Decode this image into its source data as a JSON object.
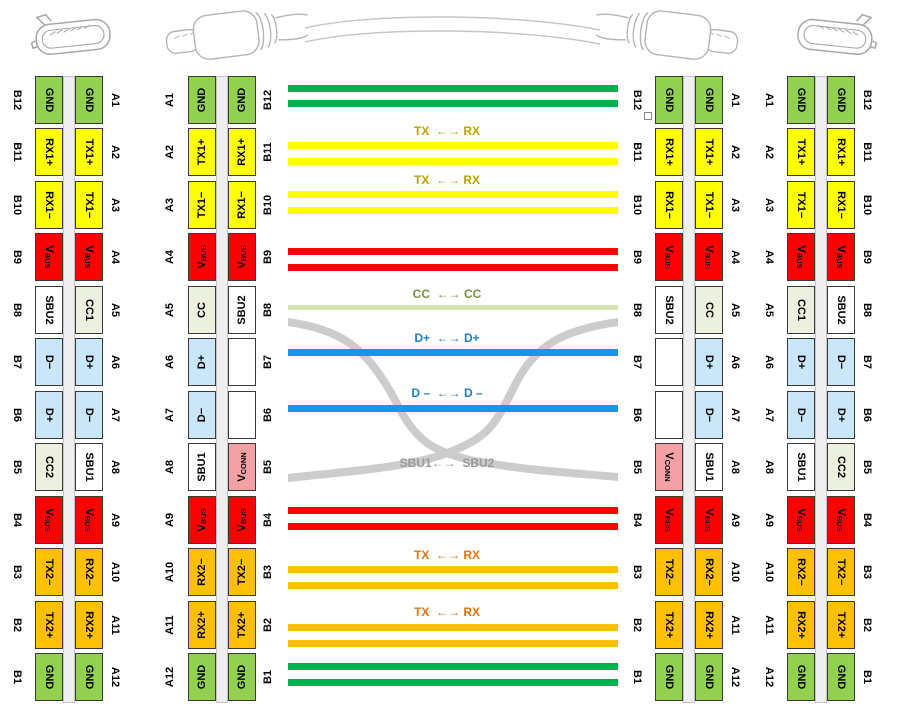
{
  "colors": {
    "pin": {
      "gnd": "#92D050",
      "hs": "#FFFF00",
      "vbus": "#FF0000",
      "sbu": "#FFFFFF",
      "cc": "#EBF1DE",
      "d": "#C9E7F8",
      "ss": "#FFC000",
      "vconn": "#F4A1A6",
      "blank": "#FFFFFF"
    },
    "wire": {
      "green": "#00B050",
      "yellow": "#FFFF00",
      "red": "#FF0000",
      "cc": "#D6E3B5",
      "blue": "#1699DC",
      "orange": "#FFC000",
      "gray": "#CCCCCC"
    }
  },
  "label_sets": {
    "A": [
      "A1",
      "A2",
      "A3",
      "A4",
      "A5",
      "A6",
      "A7",
      "A8",
      "A9",
      "A10",
      "A11",
      "A12"
    ],
    "B": [
      "B12",
      "B11",
      "B10",
      "B9",
      "B8",
      "B7",
      "B6",
      "B5",
      "B4",
      "B3",
      "B2",
      "B1"
    ]
  },
  "pinsets": {
    "recB": [
      {
        "t": "GND",
        "c": "gnd"
      },
      {
        "t": "RX1+",
        "c": "hs"
      },
      {
        "t": "RX1−",
        "c": "hs"
      },
      {
        "t": "V",
        "sub": "BUS",
        "c": "vbus"
      },
      {
        "t": "SBU2",
        "c": "sbu"
      },
      {
        "t": "D−",
        "c": "d"
      },
      {
        "t": "D+",
        "c": "d"
      },
      {
        "t": "CC2",
        "c": "cc"
      },
      {
        "t": "V",
        "sub": "BUS",
        "c": "vbus"
      },
      {
        "t": "TX2−",
        "c": "ss"
      },
      {
        "t": "TX2+",
        "c": "ss"
      },
      {
        "t": "GND",
        "c": "gnd"
      }
    ],
    "recA": [
      {
        "t": "GND",
        "c": "gnd"
      },
      {
        "t": "TX1+",
        "c": "hs"
      },
      {
        "t": "TX1−",
        "c": "hs"
      },
      {
        "t": "V",
        "sub": "BUS",
        "c": "vbus"
      },
      {
        "t": "CC1",
        "c": "cc"
      },
      {
        "t": "D+",
        "c": "d"
      },
      {
        "t": "D−",
        "c": "d"
      },
      {
        "t": "SBU1",
        "c": "sbu"
      },
      {
        "t": "V",
        "sub": "BUS",
        "c": "vbus"
      },
      {
        "t": "RX2−",
        "c": "ss"
      },
      {
        "t": "RX2+",
        "c": "ss"
      },
      {
        "t": "GND",
        "c": "gnd"
      }
    ],
    "plugA": [
      {
        "t": "GND",
        "c": "gnd"
      },
      {
        "t": "TX1+",
        "c": "hs"
      },
      {
        "t": "TX1−",
        "c": "hs"
      },
      {
        "t": "V",
        "sub": "BUS",
        "c": "vbus"
      },
      {
        "t": "CC",
        "c": "cc"
      },
      {
        "t": "D+",
        "c": "d"
      },
      {
        "t": "D−",
        "c": "d"
      },
      {
        "t": "SBU1",
        "c": "sbu"
      },
      {
        "t": "V",
        "sub": "BUS",
        "c": "vbus"
      },
      {
        "t": "RX2−",
        "c": "ss"
      },
      {
        "t": "RX2+",
        "c": "ss"
      },
      {
        "t": "GND",
        "c": "gnd"
      }
    ],
    "plugB": [
      {
        "t": "GND",
        "c": "gnd"
      },
      {
        "t": "RX1+",
        "c": "hs"
      },
      {
        "t": "RX1−",
        "c": "hs"
      },
      {
        "t": "V",
        "sub": "BUS",
        "c": "vbus"
      },
      {
        "t": "SBU2",
        "c": "sbu"
      },
      {
        "t": "",
        "c": "blank"
      },
      {
        "t": "",
        "c": "blank"
      },
      {
        "t": "V",
        "sub": "CONN",
        "c": "vconn"
      },
      {
        "t": "V",
        "sub": "BUS",
        "c": "vbus"
      },
      {
        "t": "TX2−",
        "c": "ss"
      },
      {
        "t": "TX2+",
        "c": "ss"
      },
      {
        "t": "GND",
        "c": "gnd"
      }
    ]
  },
  "groups": [
    {
      "name": "receptacle-left",
      "left": 5,
      "dir": "down",
      "left_labels": "B",
      "left_pins": "recB",
      "right_pins": "recA",
      "right_labels": "A"
    },
    {
      "name": "plug-left",
      "left": 158,
      "dir": "up",
      "left_labels": "A",
      "left_pins": "plugA",
      "right_pins": "plugB",
      "right_labels": "B"
    },
    {
      "name": "plug-right",
      "left": 625,
      "dir": "down",
      "left_labels": "B",
      "left_pins": "plugB",
      "right_pins": "plugA",
      "right_labels": "A"
    },
    {
      "name": "receptacle-right",
      "left": 757,
      "dir": "down",
      "left_labels": "A",
      "left_pins": "recA",
      "right_pins": "recB",
      "right_labels": "B"
    }
  ],
  "wires": [
    {
      "y": 85,
      "c": "green"
    },
    {
      "y": 100,
      "c": "green"
    },
    {
      "y": 142,
      "c": "yellow"
    },
    {
      "y": 158,
      "c": "yellow"
    },
    {
      "y": 191,
      "c": "yellow"
    },
    {
      "y": 207,
      "c": "yellow"
    },
    {
      "y": 248,
      "c": "red"
    },
    {
      "y": 264,
      "c": "red"
    },
    {
      "y": 305,
      "c": "cc",
      "h": 5
    },
    {
      "y": 349,
      "c": "blue"
    },
    {
      "y": 405,
      "c": "blue"
    },
    {
      "y": 507,
      "c": "red"
    },
    {
      "y": 523,
      "c": "red"
    },
    {
      "y": 566,
      "c": "orange"
    },
    {
      "y": 582,
      "c": "orange"
    },
    {
      "y": 624,
      "c": "orange"
    },
    {
      "y": 640,
      "c": "orange"
    },
    {
      "y": 663,
      "c": "green"
    },
    {
      "y": 679,
      "c": "green"
    }
  ],
  "wire_labels": [
    {
      "y": 125,
      "text": "TX  ←→ RX",
      "color": "#BCA300"
    },
    {
      "y": 174,
      "text": "TX  ←→ RX",
      "color": "#BCA300"
    },
    {
      "y": 288,
      "text": "CC  ←→ CC",
      "color": "#76923C"
    },
    {
      "y": 332,
      "text": "D+  ←→ D+",
      "color": "#1F7EC8"
    },
    {
      "y": 387,
      "text": "D –  ←→ D –",
      "color": "#1F7EC8"
    },
    {
      "y": 457,
      "text": "SBU1←→  SBU2",
      "color": "#999999"
    },
    {
      "y": 549,
      "text": "TX  ←→ RX",
      "color": "#E8730C"
    },
    {
      "y": 606,
      "text": "TX  ←→ RX",
      "color": "#E8730C"
    }
  ]
}
